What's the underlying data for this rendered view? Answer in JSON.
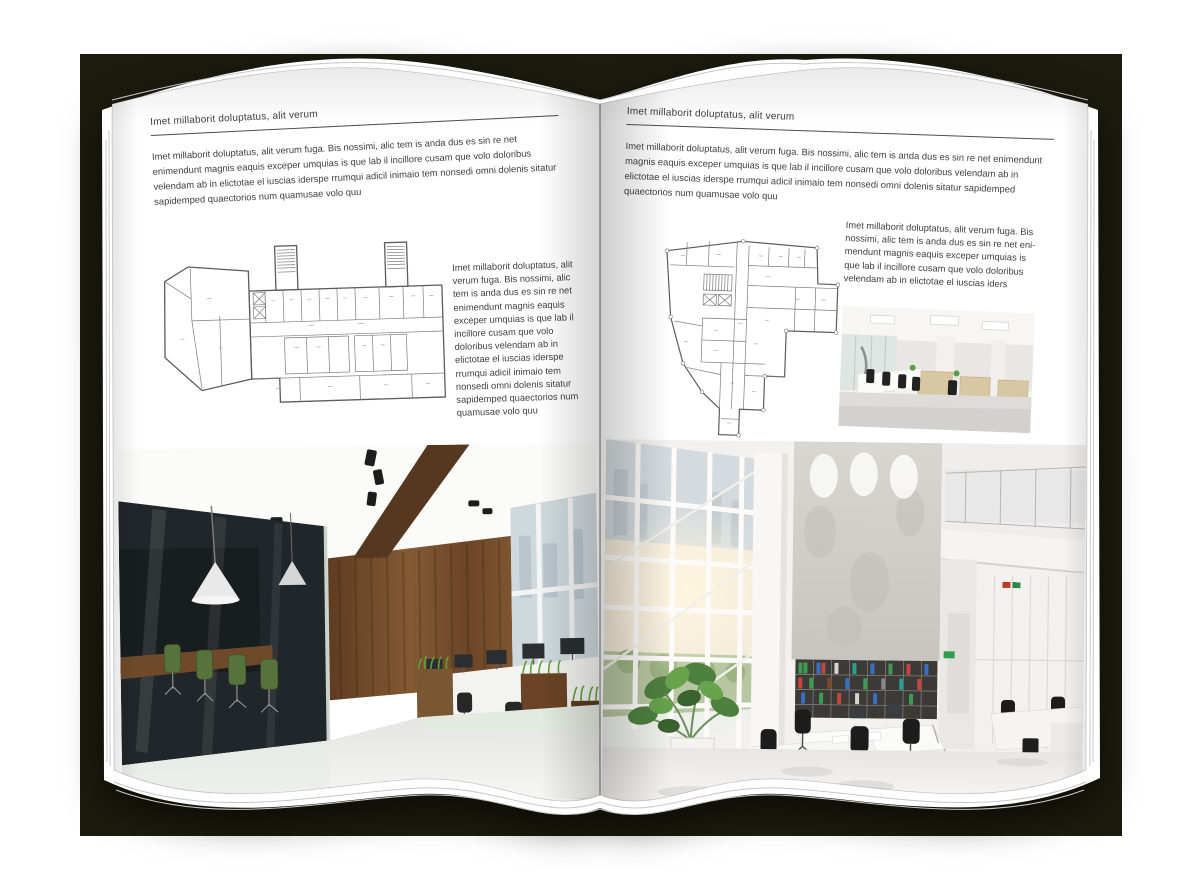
{
  "colors": {
    "backdrop": "#1c1b0e",
    "paper": "#ffffff",
    "ink": "#3d3d3d",
    "plan_line": "#6e6e6e",
    "wood_wall": "#74512f",
    "meeting_room_dark": "#21262a",
    "chair_green": "#56733c",
    "grass_green": "#5fa138",
    "binder_green": "#3f9b52",
    "binder_blue": "#3a6ec0",
    "binder_red": "#c2463d"
  },
  "left_page": {
    "header": "Imet millaborit doluptatus, alit verum",
    "intro": "Imet millaborit doluptatus, alit verum fuga. Bis nossimi, alic tem is anda dus es sin re net enimendunt magnis eaquis exceper umquias is que lab il incillore cusam que volo doloribus velendam ab in elictotae el iuscias iderspe rrumqui adicil inimaio tem nonsedi omni dolenis sitatur sapidemped quaectorios num quamusae volo quu",
    "caption": "Imet millaborit doluptatus, alit verum fuga. Bis nossimi, alic tem is anda dus es sin re net enimendunt magnis eaquis exceper umquias is que lab il incillore cusam que volo doloribus velendam ab in elictotae el iuscias iderspe rrumqui adicil inimaio tem nonsedi omni dolenis sitatur sapidemped quaectorios num quamusae volo quu"
  },
  "right_page": {
    "header": "Imet millaborit doluptatus, alit verum",
    "intro": "Imet millaborit doluptatus, alit verum fuga. Bis nossimi, alic tem is anda dus es sin re net enimendunt magnis eaquis exceper umquias is que lab il incillore cusam que volo doloribus velendam ab in elictotae el iuscias iderspe rrumqui adicil inimaio tem nonsedi omni dolenis sitatur sapidemped quaectorios num quamusae volo quu",
    "caption": "Imet millaborit doluptatus, alit verum fuga. Bis nossimi, alic tem is anda dus es sin re net eni-mendunt magnis eaquis exceper umquias is que lab il incillore cusam que volo doloribus velendam ab in elictotae el iuscias iders"
  }
}
